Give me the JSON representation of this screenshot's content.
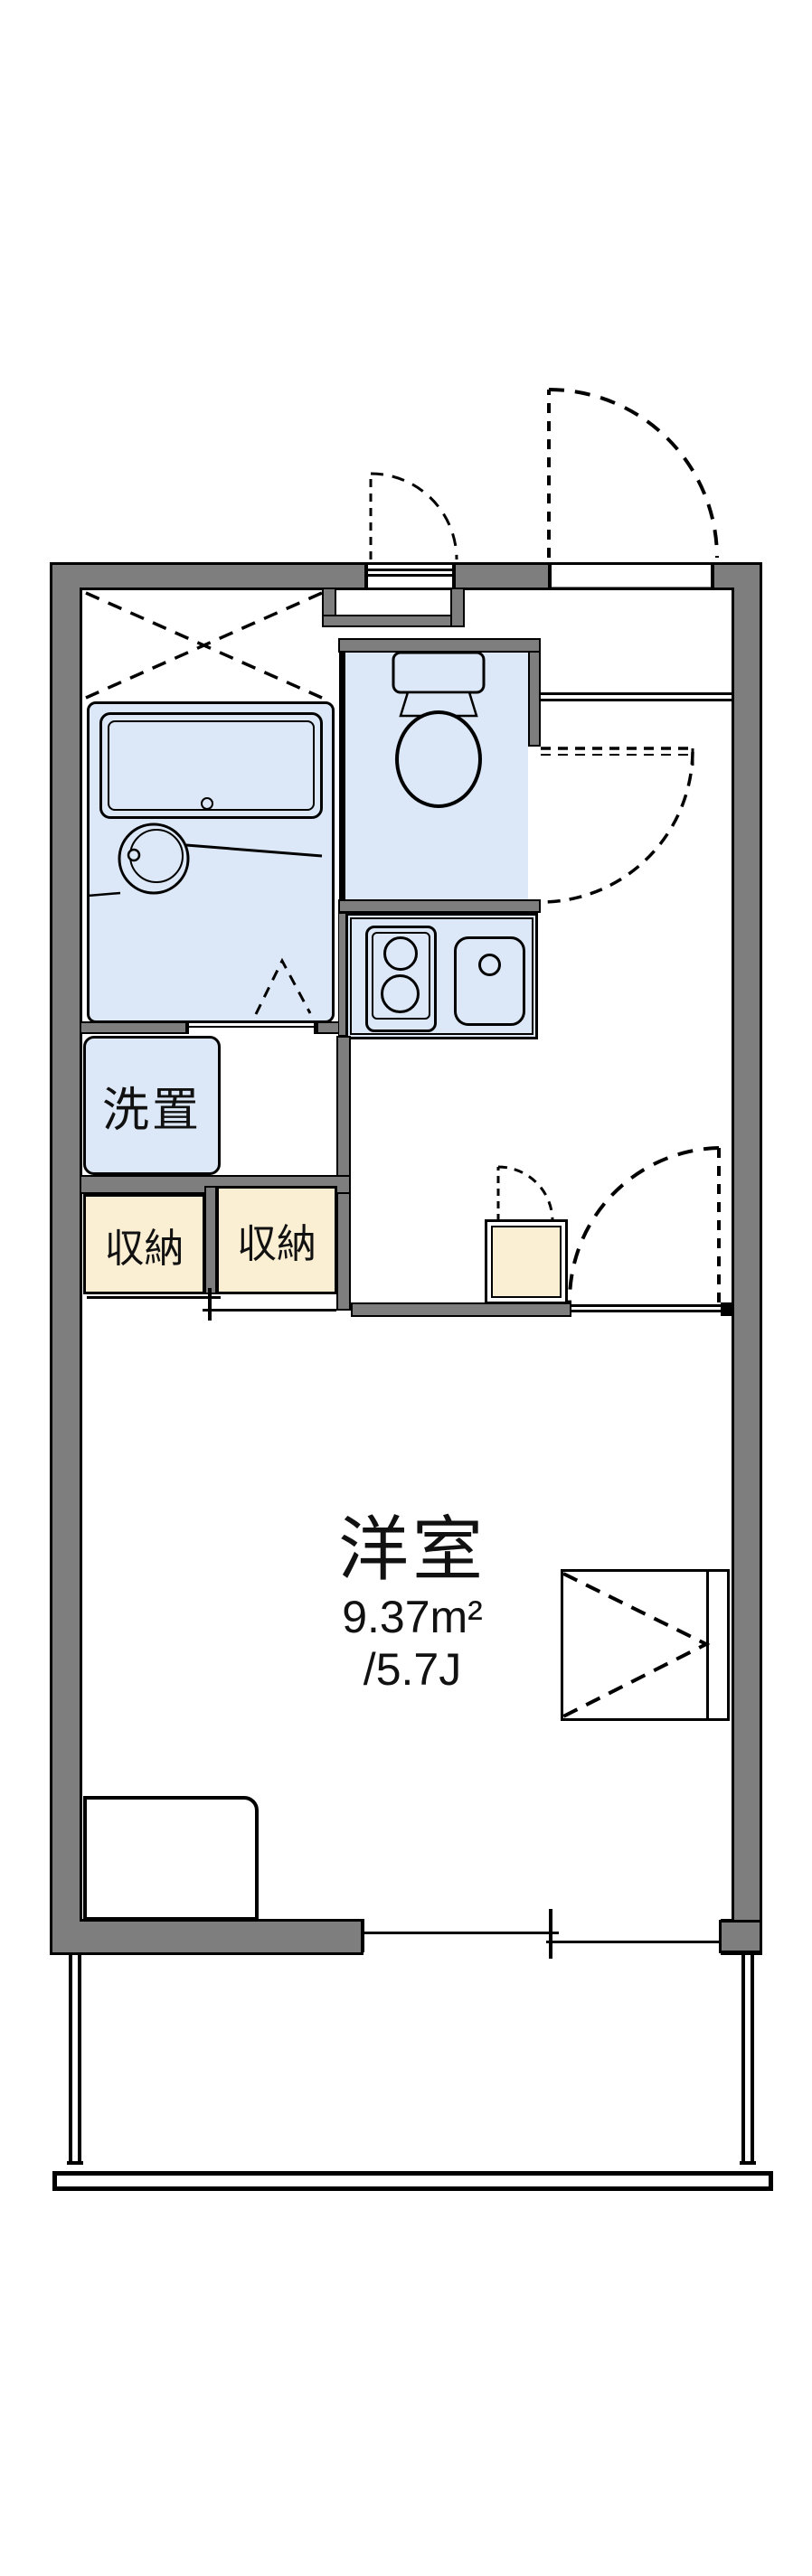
{
  "plan": {
    "type": "apartment-floor-plan",
    "rooms": {
      "main_room": {
        "label": "洋室",
        "area_sqm": "9.37m²",
        "area_tatami": "/5.7J"
      },
      "washer_place": {
        "label": "洗置"
      },
      "storage_left": {
        "label": "収納"
      },
      "storage_right": {
        "label": "収納"
      }
    },
    "fixtures": [
      "bathtub",
      "wash-basin",
      "toilet",
      "kitchen-stove",
      "kitchen-sink",
      "balcony"
    ],
    "colors": {
      "wall": "#7e7e7e",
      "line": "#000000",
      "fixture_fill": "#dce8f7",
      "storage_fill": "#faefd3",
      "background": "#ffffff"
    }
  }
}
